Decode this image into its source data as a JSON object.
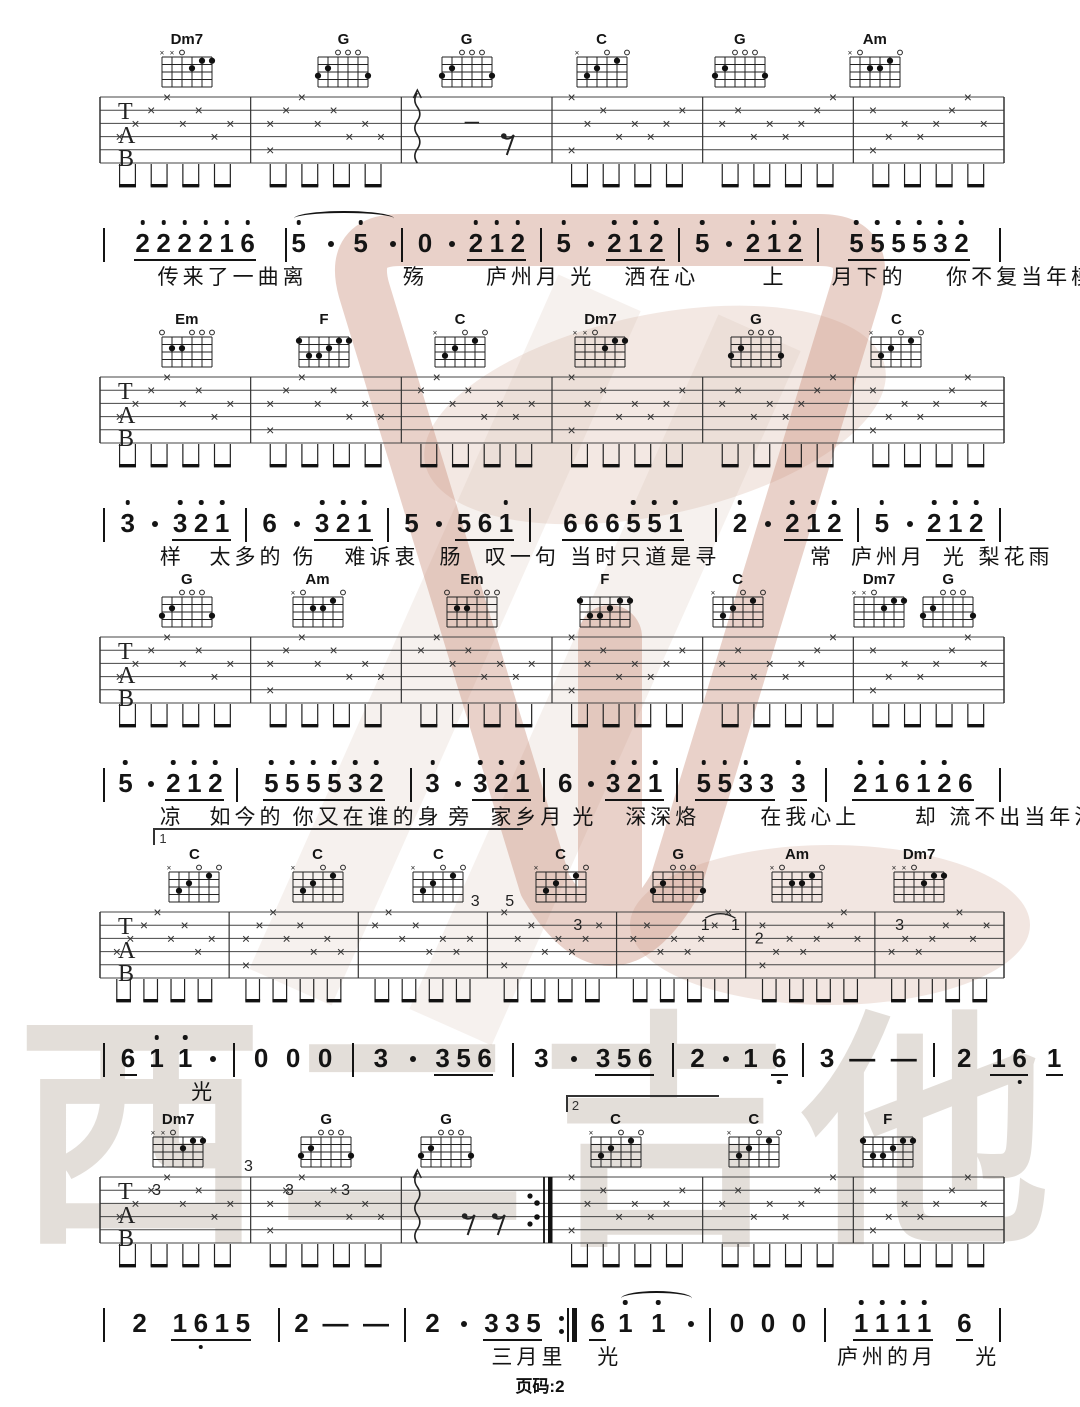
{
  "page": {
    "footer": "页码:2",
    "watermark_text": "西二吉他",
    "ink_color": "#141414",
    "watermark_pink": "#c98d79",
    "watermark_gray": "#c7bcb2"
  },
  "chord_shapes": {
    "Dm7": {
      "markers": [
        "x",
        "x",
        "o",
        "",
        "",
        ""
      ],
      "dots": [
        [
          4,
          2
        ],
        [
          5,
          1
        ],
        [
          6,
          1
        ]
      ]
    },
    "G": {
      "markers": [
        "",
        "",
        "o",
        "o",
        "o",
        ""
      ],
      "dots": [
        [
          2,
          2
        ],
        [
          1,
          3
        ],
        [
          6,
          3
        ]
      ]
    },
    "C": {
      "markers": [
        "x",
        "",
        "",
        "o",
        "",
        "o"
      ],
      "dots": [
        [
          5,
          1
        ],
        [
          3,
          2
        ],
        [
          2,
          3
        ]
      ]
    },
    "Am": {
      "markers": [
        "x",
        "o",
        "",
        "",
        "",
        "o"
      ],
      "dots": [
        [
          5,
          1
        ],
        [
          4,
          2
        ],
        [
          3,
          2
        ]
      ]
    },
    "Em": {
      "markers": [
        "o",
        "",
        "",
        "o",
        "o",
        "o"
      ],
      "dots": [
        [
          2,
          2
        ],
        [
          3,
          2
        ]
      ]
    },
    "F": {
      "markers": [
        "",
        "",
        "",
        "",
        "",
        ""
      ],
      "dots": [
        [
          1,
          1
        ],
        [
          5,
          1
        ],
        [
          6,
          1
        ],
        [
          4,
          2
        ],
        [
          2,
          3
        ],
        [
          3,
          3
        ]
      ]
    }
  },
  "systems": [
    {
      "chords": [
        {
          "name": "Dm7",
          "x": 17.3
        },
        {
          "name": "G",
          "x": 31.8
        },
        {
          "name": "G",
          "x": 43.2
        },
        {
          "name": "C",
          "x": 55.7
        },
        {
          "name": "G",
          "x": 68.5
        },
        {
          "name": "Am",
          "x": 81.0
        }
      ],
      "tab": {
        "measures": 6,
        "special": [
          {
            "measure": 2,
            "type": "arp1"
          }
        ],
        "annotations": [],
        "slurs": [],
        "repeat_end_after": null
      },
      "jianpu": [
        {
          "items": [
            {
              "g": [
                "2'",
                "2'",
                "2'",
                "2'",
                "1'",
                "6'"
              ]
            }
          ],
          "bar": "|"
        },
        {
          "items": [
            {
              "tie": [
                "5'.",
                "5'."
              ]
            }
          ],
          "bar": "|"
        },
        {
          "items": [
            "0.",
            {
              "g": [
                "2'",
                "1'",
                "2'"
              ]
            }
          ],
          "bar": "|"
        },
        {
          "items": [
            "5'.",
            {
              "g": [
                "2'",
                "1'",
                "2'"
              ]
            }
          ],
          "bar": "|"
        },
        {
          "items": [
            "5'.",
            {
              "g": [
                "2'",
                "1'",
                "2'"
              ]
            }
          ],
          "bar": "|"
        },
        {
          "items": [
            {
              "g": [
                "5'",
                "5'",
                "5'",
                "5'",
                "3'",
                "2'"
              ]
            }
          ],
          "bar": "|"
        }
      ],
      "lyrics": [
        {
          "t": "传来了一曲离",
          "x": 14.6
        },
        {
          "t": "殇",
          "x": 37.3
        },
        {
          "t": "庐州月",
          "x": 45.0
        },
        {
          "t": "光",
          "x": 52.8
        },
        {
          "t": "洒在心",
          "x": 57.8
        },
        {
          "t": "上",
          "x": 70.6
        },
        {
          "t": "月下的",
          "x": 77.0
        },
        {
          "t": "你不复当年模",
          "x": 87.6
        }
      ],
      "volta": null
    },
    {
      "chords": [
        {
          "name": "Em",
          "x": 17.3
        },
        {
          "name": "F",
          "x": 30.0
        },
        {
          "name": "C",
          "x": 42.6
        },
        {
          "name": "Dm7",
          "x": 55.6
        },
        {
          "name": "G",
          "x": 70.0
        },
        {
          "name": "C",
          "x": 83.0
        }
      ],
      "tab": {
        "measures": 6,
        "special": [],
        "annotations": [],
        "slurs": [],
        "repeat_end_after": null
      },
      "jianpu": [
        {
          "items": [
            "3'.",
            {
              "g": [
                "3'",
                "2'",
                "1'"
              ]
            }
          ],
          "bar": "|"
        },
        {
          "items": [
            "6.",
            {
              "g": [
                "3'",
                "2'",
                "1'"
              ]
            }
          ],
          "bar": "|"
        },
        {
          "items": [
            "5.",
            {
              "g": [
                "5",
                "6",
                "1'"
              ]
            }
          ],
          "bar": "|"
        },
        {
          "items": [
            {
              "g": [
                "6",
                "6",
                "6",
                "5'",
                "5'",
                "1'"
              ]
            }
          ],
          "bar": "|"
        },
        {
          "items": [
            "2'.",
            {
              "g": [
                "2'",
                "1'",
                "2'"
              ]
            }
          ],
          "bar": "|"
        },
        {
          "items": [
            "5'.",
            {
              "g": [
                "2'",
                "1'",
                "2'"
              ]
            }
          ],
          "bar": "|"
        }
      ],
      "lyrics": [
        {
          "t": "样",
          "x": 14.8
        },
        {
          "t": "太多的",
          "x": 19.4
        },
        {
          "t": "伤",
          "x": 27.1
        },
        {
          "t": "难诉衷",
          "x": 31.9
        },
        {
          "t": "肠",
          "x": 40.7
        },
        {
          "t": "叹一句",
          "x": 44.9
        },
        {
          "t": "当时只道是寻",
          "x": 52.8
        },
        {
          "t": "常",
          "x": 75.0
        },
        {
          "t": "庐州月",
          "x": 78.8
        },
        {
          "t": "光",
          "x": 87.3
        },
        {
          "t": "梨花雨",
          "x": 90.6
        }
      ],
      "volta": null
    },
    {
      "chords": [
        {
          "name": "G",
          "x": 17.3
        },
        {
          "name": "Am",
          "x": 29.4
        },
        {
          "name": "Em",
          "x": 43.7
        },
        {
          "name": "F",
          "x": 56.0
        },
        {
          "name": "C",
          "x": 68.3
        },
        {
          "name": "Dm7",
          "x": 81.4
        },
        {
          "name": "G",
          "x": 87.8
        }
      ],
      "tab": {
        "measures": 6,
        "special": [],
        "annotations": [],
        "slurs": [],
        "repeat_end_after": null
      },
      "jianpu": [
        {
          "items": [
            "5'.",
            {
              "g": [
                "2'",
                "1'",
                "2'"
              ]
            }
          ],
          "bar": "|"
        },
        {
          "items": [
            {
              "g": [
                "5'",
                "5'",
                "5'",
                "5'",
                "3'",
                "2'"
              ]
            }
          ],
          "bar": "|"
        },
        {
          "items": [
            "3'.",
            {
              "g": [
                "3'",
                "2'",
                "1'"
              ]
            }
          ],
          "bar": "|"
        },
        {
          "items": [
            "6.",
            {
              "g": [
                "3'",
                "2'",
                "1'"
              ]
            }
          ],
          "bar": "|"
        },
        {
          "items": [
            {
              "g": [
                "5'",
                "5'",
                "3'",
                "3"
              ]
            },
            {
              "g": [
                "3'"
              ]
            }
          ],
          "bar": "|"
        },
        {
          "items": [
            {
              "g": [
                "2'",
                "1'",
                "6",
                "1'",
                "2'",
                "6"
              ]
            }
          ],
          "bar": "|"
        }
      ],
      "lyrics": [
        {
          "t": "凉",
          "x": 14.8
        },
        {
          "t": "如今的",
          "x": 19.4
        },
        {
          "t": "你又在谁的身",
          "x": 27.1
        },
        {
          "t": "旁",
          "x": 41.5
        },
        {
          "t": "家乡月",
          "x": 45.4
        },
        {
          "t": "光",
          "x": 53.0
        },
        {
          "t": "深深烙",
          "x": 57.9
        },
        {
          "t": "在我心上",
          "x": 70.4
        },
        {
          "t": "却",
          "x": 84.7
        },
        {
          "t": "流不出当年泪",
          "x": 87.9
        }
      ],
      "volta": {
        "label": "1",
        "x": 14.2,
        "w": 34.0
      }
    },
    {
      "chords": [
        {
          "name": "C",
          "x": 18.0
        },
        {
          "name": "C",
          "x": 29.4
        },
        {
          "name": "C",
          "x": 40.6
        },
        {
          "name": "C",
          "x": 51.9
        },
        {
          "name": "G",
          "x": 62.8
        },
        {
          "name": "Am",
          "x": 73.8
        },
        {
          "name": "Dm7",
          "x": 85.1
        }
      ],
      "tab": {
        "measures": 7,
        "special": [],
        "annotations": [
          {
            "x": 44.0,
            "l": 0,
            "t": "3"
          },
          {
            "x": 47.2,
            "l": 0,
            "t": "5"
          },
          {
            "x": 53.5,
            "l": 2,
            "t": "3"
          },
          {
            "x": 65.3,
            "l": 2,
            "t": "1"
          },
          {
            "x": 68.1,
            "l": 2,
            "t": "1"
          },
          {
            "x": 70.3,
            "l": 3,
            "t": "2"
          },
          {
            "x": 83.3,
            "l": 2,
            "t": "3"
          }
        ],
        "slurs": [
          {
            "x1": 65.3,
            "x2": 68.1,
            "l": 2
          }
        ],
        "repeat_end_after": null
      },
      "jianpu": [
        {
          "items": [
            {
              "g": [
                "6"
              ]
            },
            "1'",
            "1'."
          ],
          "bar": "|"
        },
        {
          "items": [
            "0",
            "0",
            "0"
          ],
          "bar": "|"
        },
        {
          "items": [
            "3.",
            {
              "g": [
                "3",
                "5",
                "6"
              ]
            }
          ],
          "bar": "|"
        },
        {
          "items": [
            "3.",
            {
              "g": [
                "3",
                "5",
                "6"
              ]
            }
          ],
          "bar": "|"
        },
        {
          "items": [
            "2.",
            "1",
            {
              "g": [
                "6,"
              ]
            }
          ],
          "bar": "|"
        },
        {
          "items": [
            "3",
            "-",
            "-"
          ],
          "bar": "|"
        },
        {
          "items": [
            "2",
            {
              "g": [
                "1",
                "6,"
              ]
            },
            {
              "g": [
                "1"
              ]
            }
          ],
          "bar": ""
        }
      ],
      "lyrics": [
        {
          "t": "光",
          "x": 17.7
        }
      ],
      "volta": {
        "label": "2",
        "x": 52.4,
        "w": 14.0
      }
    },
    {
      "chords": [
        {
          "name": "Dm7",
          "x": 16.5
        },
        {
          "name": "G",
          "x": 30.2
        },
        {
          "name": "G",
          "x": 41.3
        },
        {
          "name": "C",
          "x": 57.0
        },
        {
          "name": "C",
          "x": 69.8
        },
        {
          "name": "F",
          "x": 82.2
        }
      ],
      "tab": {
        "measures": 6,
        "special": [
          {
            "measure": 2,
            "type": "arp2"
          }
        ],
        "annotations": [
          {
            "x": 14.5,
            "l": 2,
            "t": "3"
          },
          {
            "x": 23.0,
            "l": 0,
            "t": "3"
          },
          {
            "x": 26.8,
            "l": 2,
            "t": "3"
          },
          {
            "x": 32.0,
            "l": 2,
            "t": "3"
          }
        ],
        "slurs": [],
        "repeat_end_after": 3
      },
      "jianpu": [
        {
          "items": [
            "2",
            {
              "g": [
                "1",
                "6,",
                "1",
                "5"
              ]
            }
          ],
          "bar": "|"
        },
        {
          "items": [
            "2",
            "-",
            "-"
          ],
          "bar": "|"
        },
        {
          "items": [
            "2.",
            {
              "g": [
                "3",
                "3",
                "5"
              ]
            }
          ],
          "bar": ":||"
        },
        {
          "items": [
            {
              "g": [
                "6"
              ]
            },
            {
              "tie": [
                "1'",
                "1'."
              ]
            }
          ],
          "bar": "|"
        },
        {
          "items": [
            "0",
            "0",
            "0"
          ],
          "bar": "|"
        },
        {
          "items": [
            {
              "g": [
                "1'",
                "1'",
                "1'",
                "1'"
              ]
            },
            {
              "g": [
                "6"
              ]
            }
          ],
          "bar": "|"
        }
      ],
      "lyrics": [
        {
          "t": "三月里",
          "x": 45.5
        },
        {
          "t": "光",
          "x": 55.3
        },
        {
          "t": "庐州的月",
          "x": 77.5
        },
        {
          "t": "光",
          "x": 90.3
        }
      ],
      "volta": null
    }
  ]
}
